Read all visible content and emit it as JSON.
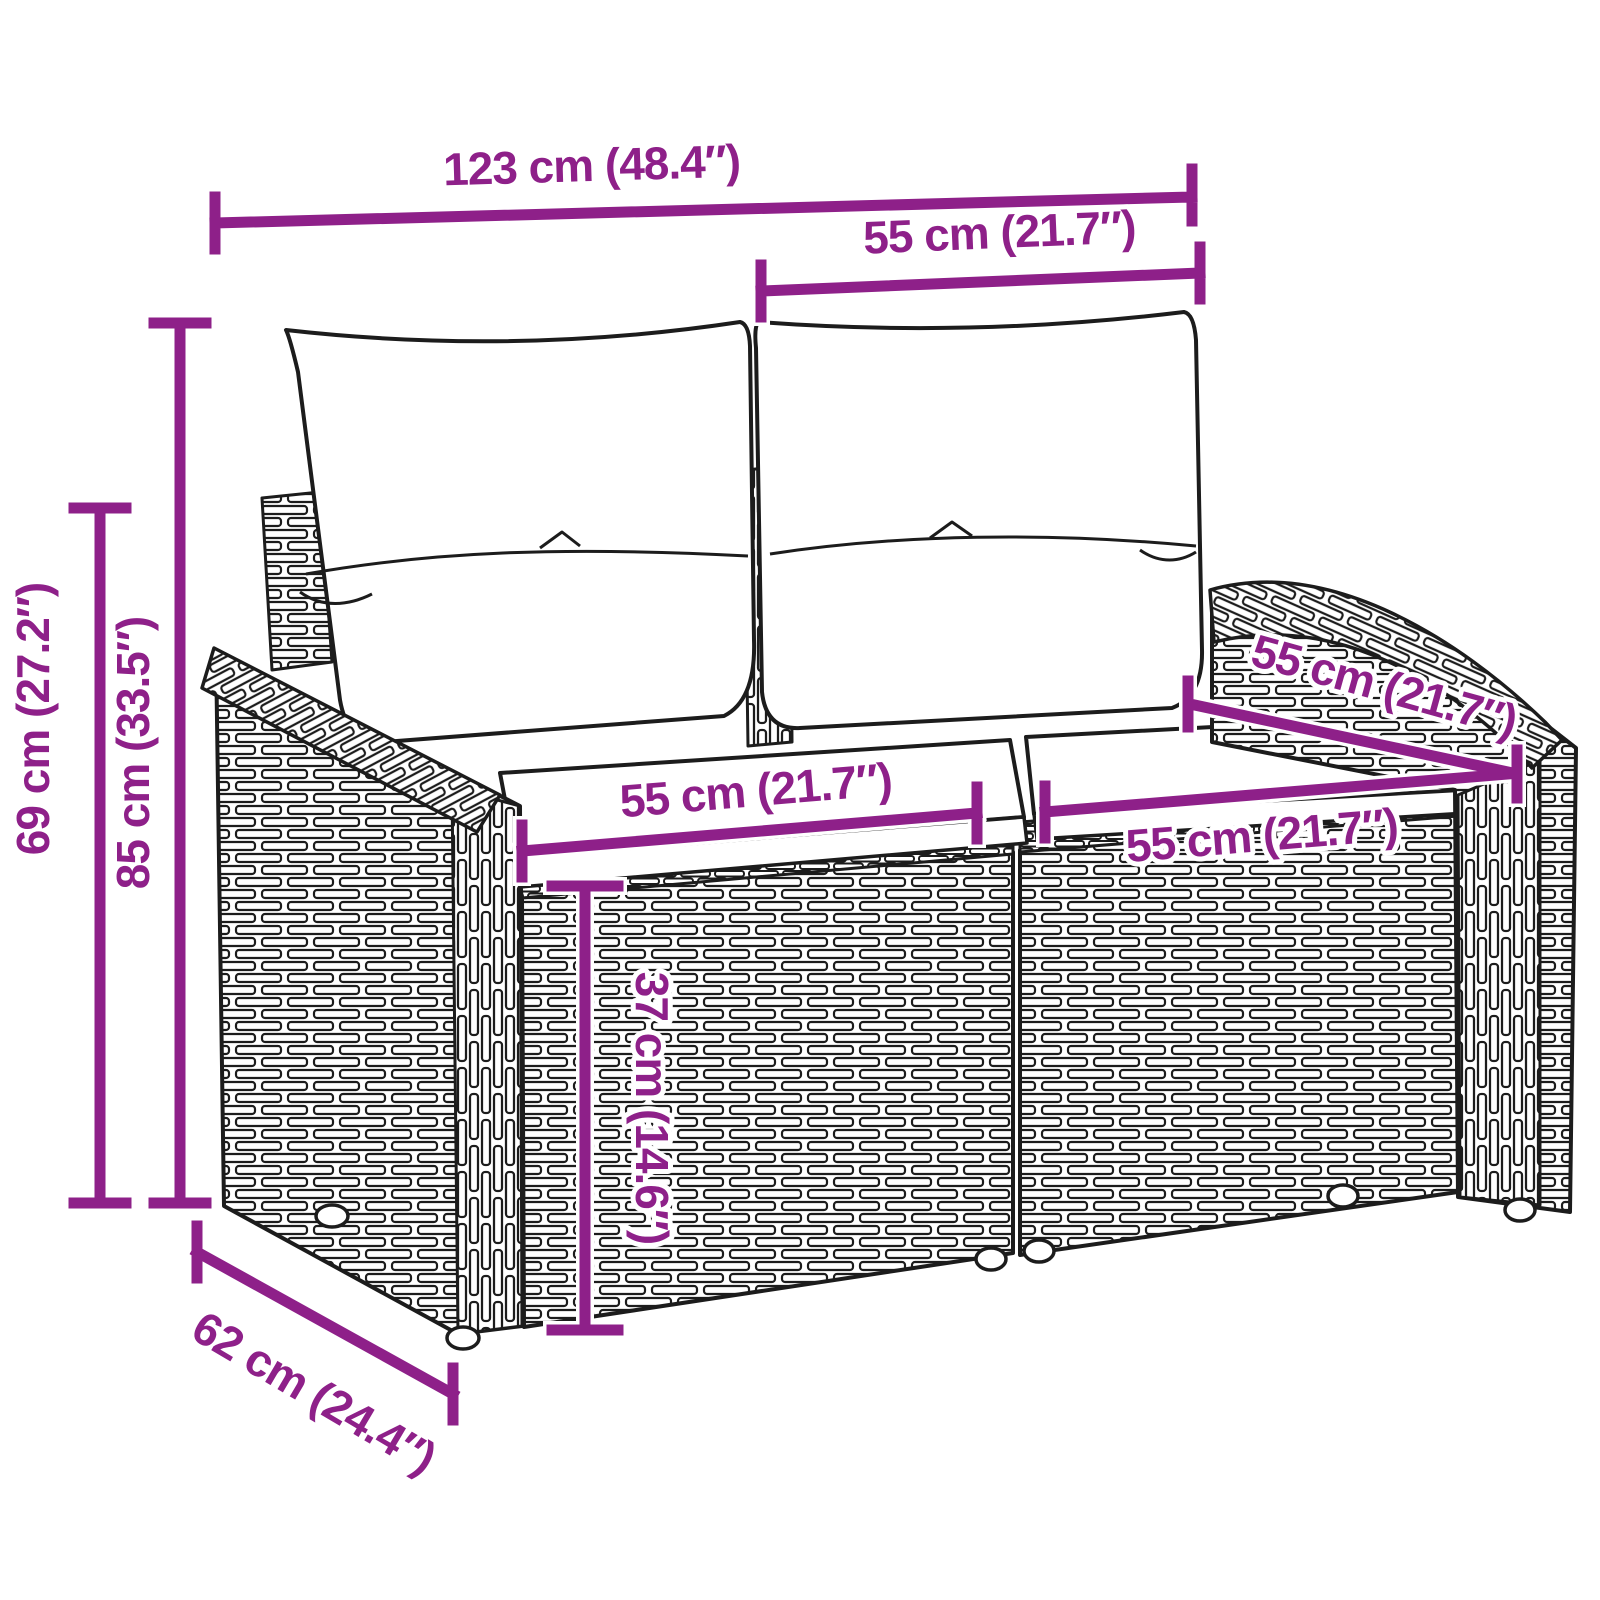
{
  "title": "Rattan garden 2-seater sofa dimension diagram",
  "colors": {
    "dimension_accent": "#8E2089",
    "line_art": "#1c1c1c",
    "background": "#ffffff",
    "cushion_fill": "#ffffff"
  },
  "dimensions": {
    "overall_width": "123 cm (48.4″)",
    "back_cushion_width": "55 cm (21.7″)",
    "seat_depth_top": "55 cm (21.7″)",
    "seat_width_left": "55 cm (21.7″)",
    "seat_width_right": "55 cm (21.7″)",
    "total_height": "85 cm (33.5″)",
    "back_height": "69 cm (27.2″)",
    "seat_height": "37 cm (14.6″)",
    "depth": "62 cm (24.4″)"
  },
  "furniture": {
    "type": "poly-rattan 2-seater garden bench with back and seat cushions",
    "parts": [
      "left back cushion",
      "right back cushion",
      "left seat cushion",
      "right seat cushion",
      "left armrest",
      "right armrest",
      "wicker body",
      "feet"
    ]
  }
}
